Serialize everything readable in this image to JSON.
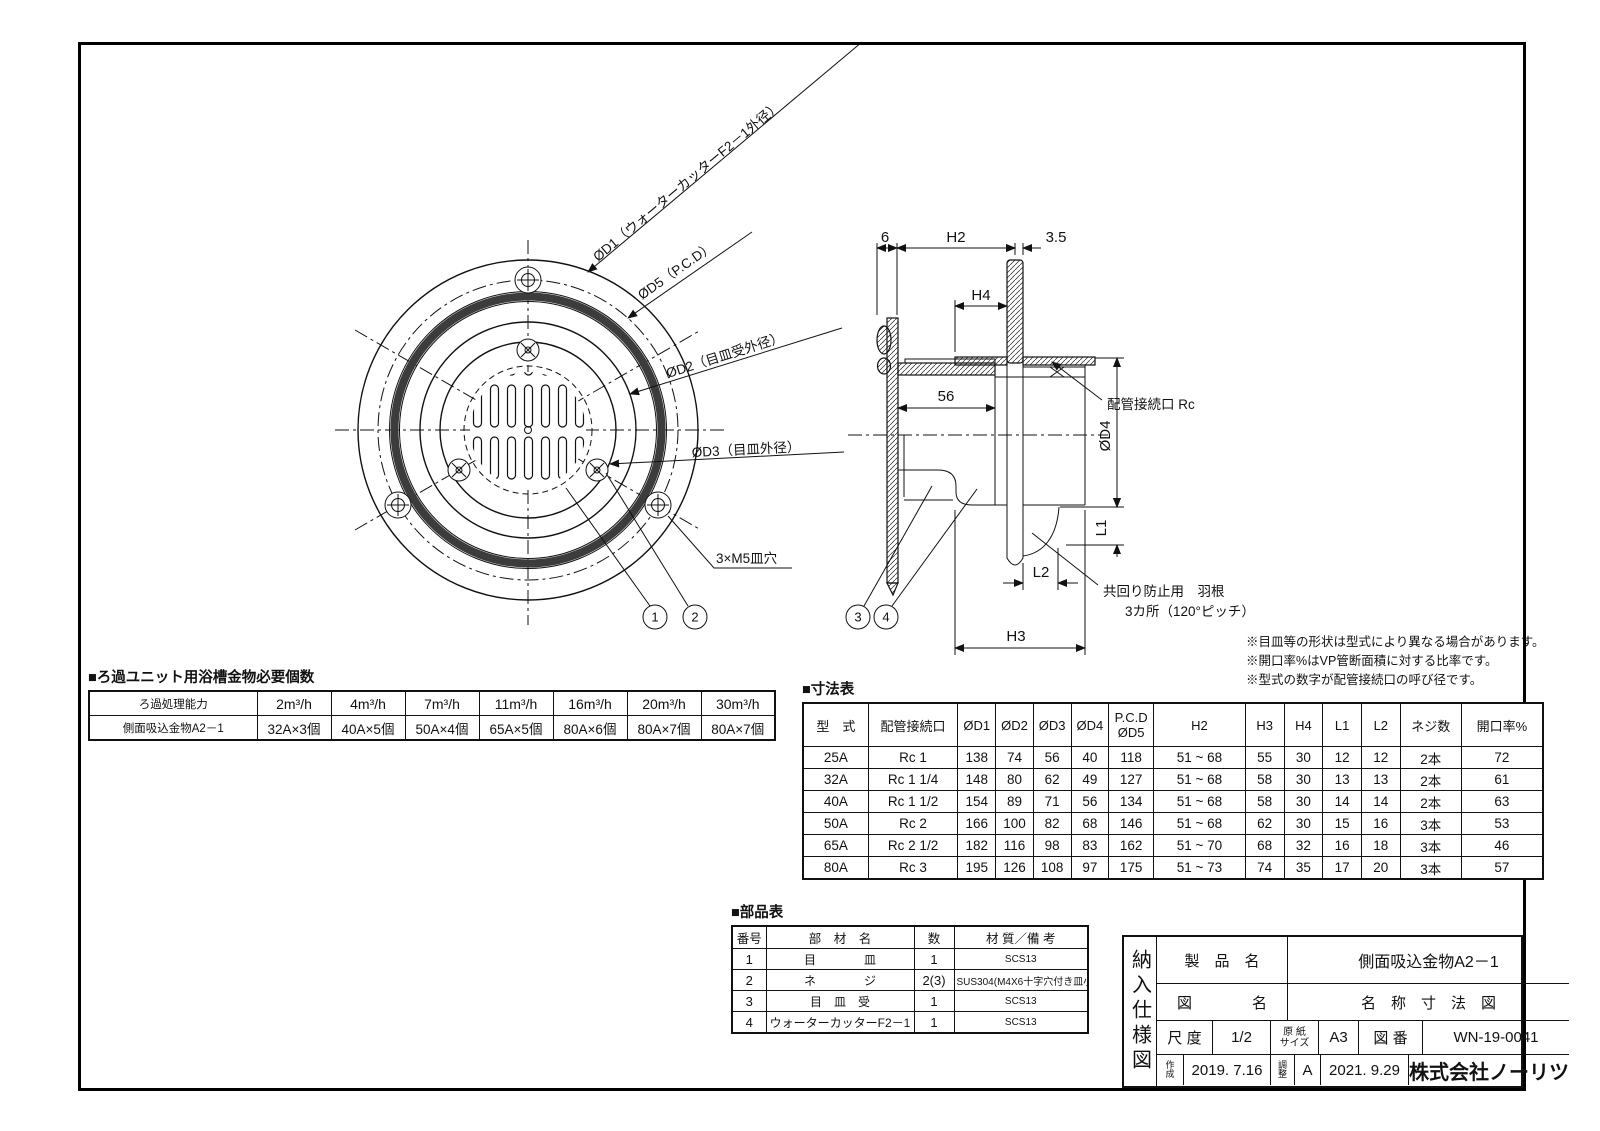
{
  "front_view": {
    "labels": {
      "d1": "ØD1（ウォーターカッターF2－1外径）",
      "d5": "ØD5（P.C.D）",
      "d2": "ØD2（目皿受外径）",
      "d3": "ØD3（目皿外径）",
      "m5": "3×M5皿穴",
      "balloon1": "1",
      "balloon2": "2"
    }
  },
  "section_view": {
    "labels": {
      "dim6": "6",
      "dimH2": "H2",
      "dim35": "3.5",
      "dimH4": "H4",
      "dim56": "56",
      "d4": "ØD4",
      "rc": "配管接続口 Rc",
      "dimL1": "L1",
      "dimL2": "L2",
      "dimH3": "H3",
      "wing_note_line1": "共回り防止用　羽根",
      "wing_note_line2": "3カ所（120°ピッチ）",
      "balloon3": "3",
      "balloon4": "4"
    }
  },
  "notes": {
    "line1": "※目皿等の形状は型式により異なる場合があります。",
    "line2": "※開口率%はVP管断面積に対する比率です。",
    "line3": "※型式の数字が配管接続口の呼び径です。"
  },
  "capacity_table": {
    "title": "■ろ過ユニット用浴槽金物必要個数",
    "header": [
      "ろ過処理能力",
      "2m³/h",
      "4m³/h",
      "7m³/h",
      "11m³/h",
      "16m³/h",
      "20m³/h",
      "30m³/h"
    ],
    "rows": [
      [
        "側面吸込金物A2－1",
        "32A×3個",
        "40A×5個",
        "50A×4個",
        "65A×5個",
        "80A×6個",
        "80A×7個",
        "80A×7個"
      ]
    ]
  },
  "dimension_table": {
    "title": "■寸法表",
    "header": [
      "型　式",
      "配管接続口",
      "ØD1",
      "ØD2",
      "ØD3",
      "ØD4",
      "P.C.D\nØD5",
      "H2",
      "H3",
      "H4",
      "L1",
      "L2",
      "ネジ数",
      "開口率%"
    ],
    "rows": [
      [
        "25A",
        "Rc 1",
        "138",
        "74",
        "56",
        "40",
        "118",
        "51 ~ 68",
        "55",
        "30",
        "12",
        "12",
        "2本",
        "72"
      ],
      [
        "32A",
        "Rc 1 1/4",
        "148",
        "80",
        "62",
        "49",
        "127",
        "51 ~ 68",
        "58",
        "30",
        "13",
        "13",
        "2本",
        "61"
      ],
      [
        "40A",
        "Rc 1 1/2",
        "154",
        "89",
        "71",
        "56",
        "134",
        "51 ~ 68",
        "58",
        "30",
        "14",
        "14",
        "2本",
        "63"
      ],
      [
        "50A",
        "Rc 2",
        "166",
        "100",
        "82",
        "68",
        "146",
        "51 ~ 68",
        "62",
        "30",
        "15",
        "16",
        "3本",
        "53"
      ],
      [
        "65A",
        "Rc 2 1/2",
        "182",
        "116",
        "98",
        "83",
        "162",
        "51 ~ 70",
        "68",
        "32",
        "16",
        "18",
        "3本",
        "46"
      ],
      [
        "80A",
        "Rc 3",
        "195",
        "126",
        "108",
        "97",
        "175",
        "51 ~ 73",
        "74",
        "35",
        "17",
        "20",
        "3本",
        "57"
      ]
    ]
  },
  "parts_table": {
    "title": "■部品表",
    "header": [
      "番号",
      "部　材　名",
      "数",
      "材 質／備 考"
    ],
    "rows": [
      [
        "1",
        "目　　　　皿",
        "1",
        "SCS13"
      ],
      [
        "2",
        "ネ　　　　ジ",
        "2(3)",
        "SUS304(M4X6十字穴付き皿小ネジ)"
      ],
      [
        "3",
        "目　皿　受",
        "1",
        "SCS13"
      ],
      [
        "4",
        "ウォーターカッターF2－1",
        "1",
        "SCS13"
      ]
    ]
  },
  "title_block": {
    "side_label": "納入仕様図",
    "product_label": "製　品　名",
    "product_name": "側面吸込金物A2－1",
    "drawing_label": "図　　　　名",
    "drawing_name": "名　称　寸　法　図",
    "scale_label": "尺 度",
    "scale_value": "1/2",
    "paper_label": "原 紙\nサイズ",
    "paper_value": "A3",
    "number_label": "図 番",
    "number_value": "WN-19-0041",
    "created_label": "作\n成",
    "created_value": "2019. 7.16",
    "revised_label": "調\n整",
    "revision": "A",
    "revised_value": "2021. 9.29",
    "company": "株式会社ノーリツ"
  }
}
